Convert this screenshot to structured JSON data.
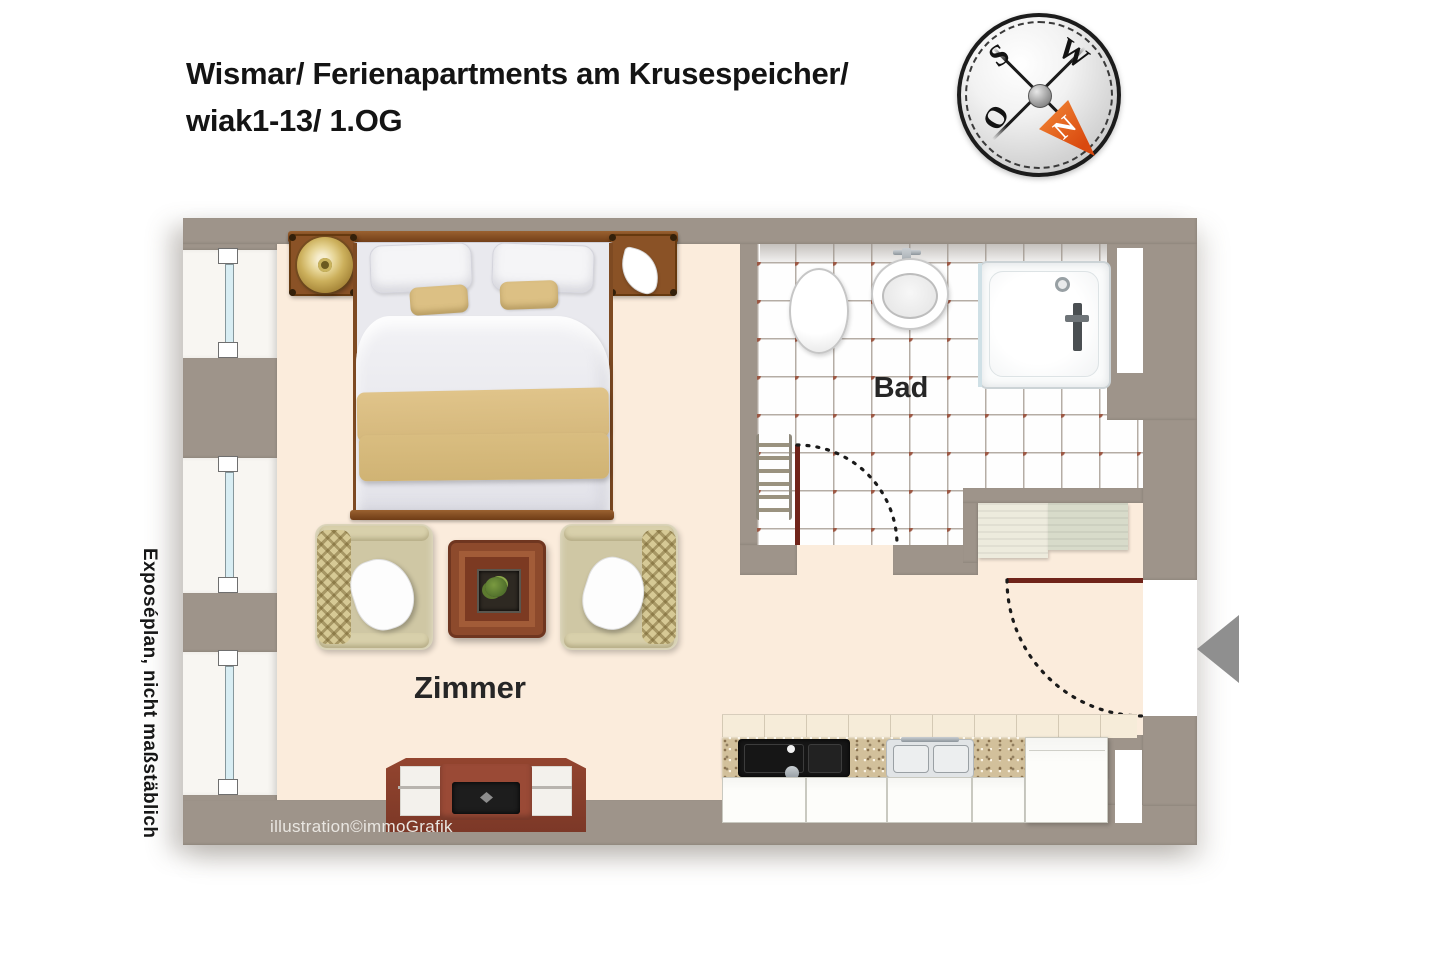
{
  "header": {
    "title_line1": "Wismar/ Ferienapartments am Krusespeicher/",
    "title_line2": "wiak1-13/ 1.OG"
  },
  "compass": {
    "south": "S",
    "west": "W",
    "east": "O",
    "north": "N"
  },
  "plan": {
    "room_labels": {
      "bathroom": "Bad",
      "living_room": "Zimmer"
    },
    "side_note": "Exposéplan, nicht maßstäblich",
    "credit": "illustration©immoGrafik",
    "colors": {
      "wall": "#9e948a",
      "floor": "#fbecdc",
      "tile_dot": "#9c5844",
      "tile_line": "#b5ada5",
      "window_glass": "#d8edf3",
      "door": "#70241a",
      "wood": "#8a5226",
      "accent_textile": "#dcc084"
    }
  }
}
